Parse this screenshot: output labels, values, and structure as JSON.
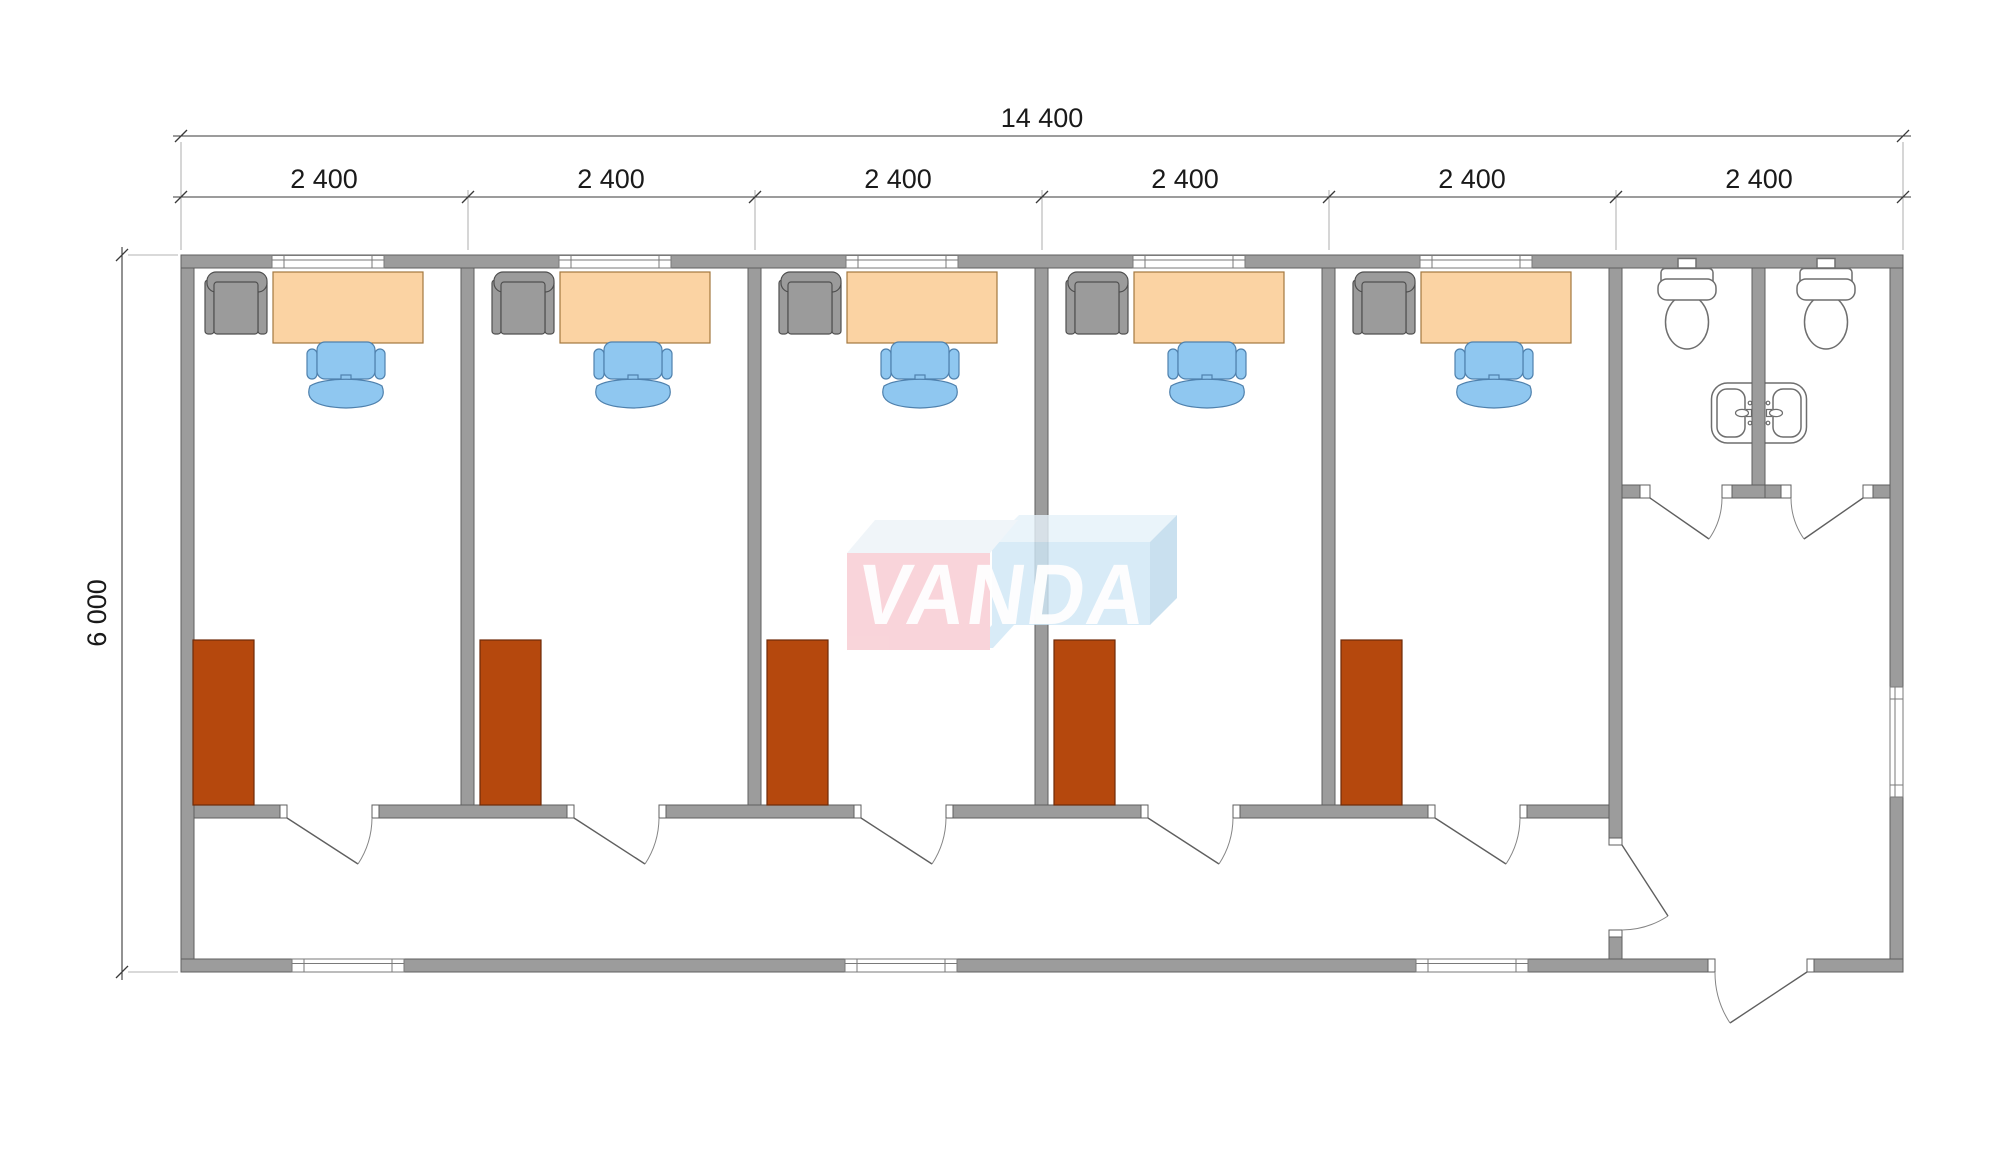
{
  "dimensions": {
    "total_width": "14 400",
    "total_depth": "6 000",
    "modules": [
      "2 400",
      "2 400",
      "2 400",
      "2 400",
      "2 400",
      "2 400"
    ]
  },
  "watermark": {
    "text": "VANDA"
  },
  "inventory": {
    "office_rooms": 5,
    "desks": 5,
    "task_chairs": 5,
    "armchairs": 5,
    "cabinets": 5,
    "toilets": 2,
    "sink_basins": 2,
    "windows_top": 5,
    "windows_bottom": 3,
    "windows_right": 1,
    "office_doors": 5,
    "wc_doors": 2,
    "lobby_doors": 1,
    "entrance_doors": 1
  },
  "colors": {
    "wall": "#9c9c9c",
    "wall_line": "#5f5f5f",
    "glass_line": "#7a7a7a",
    "desk": "#fbd3a3",
    "desk_line": "#a3783f",
    "chair": "#8fc7f0",
    "chair_line": "#4f81ad",
    "armchair": "#9b9b9b",
    "armchair_line": "#4f4f4f",
    "cabinet": "#b5480d",
    "cabinet_line": "#6e2a08",
    "fixture_line": "#6e6e6e",
    "dim_line": "#3a3a3a",
    "dim_text": "#1a1a1a",
    "logo_pink": "#f8cad1",
    "logo_pink_top": "#edf3f8",
    "logo_blue": "#cfe7f6",
    "logo_blue_top": "#e6f2fa",
    "logo_blue_side": "#bcd9ec",
    "logo_text": "#ffffff"
  }
}
